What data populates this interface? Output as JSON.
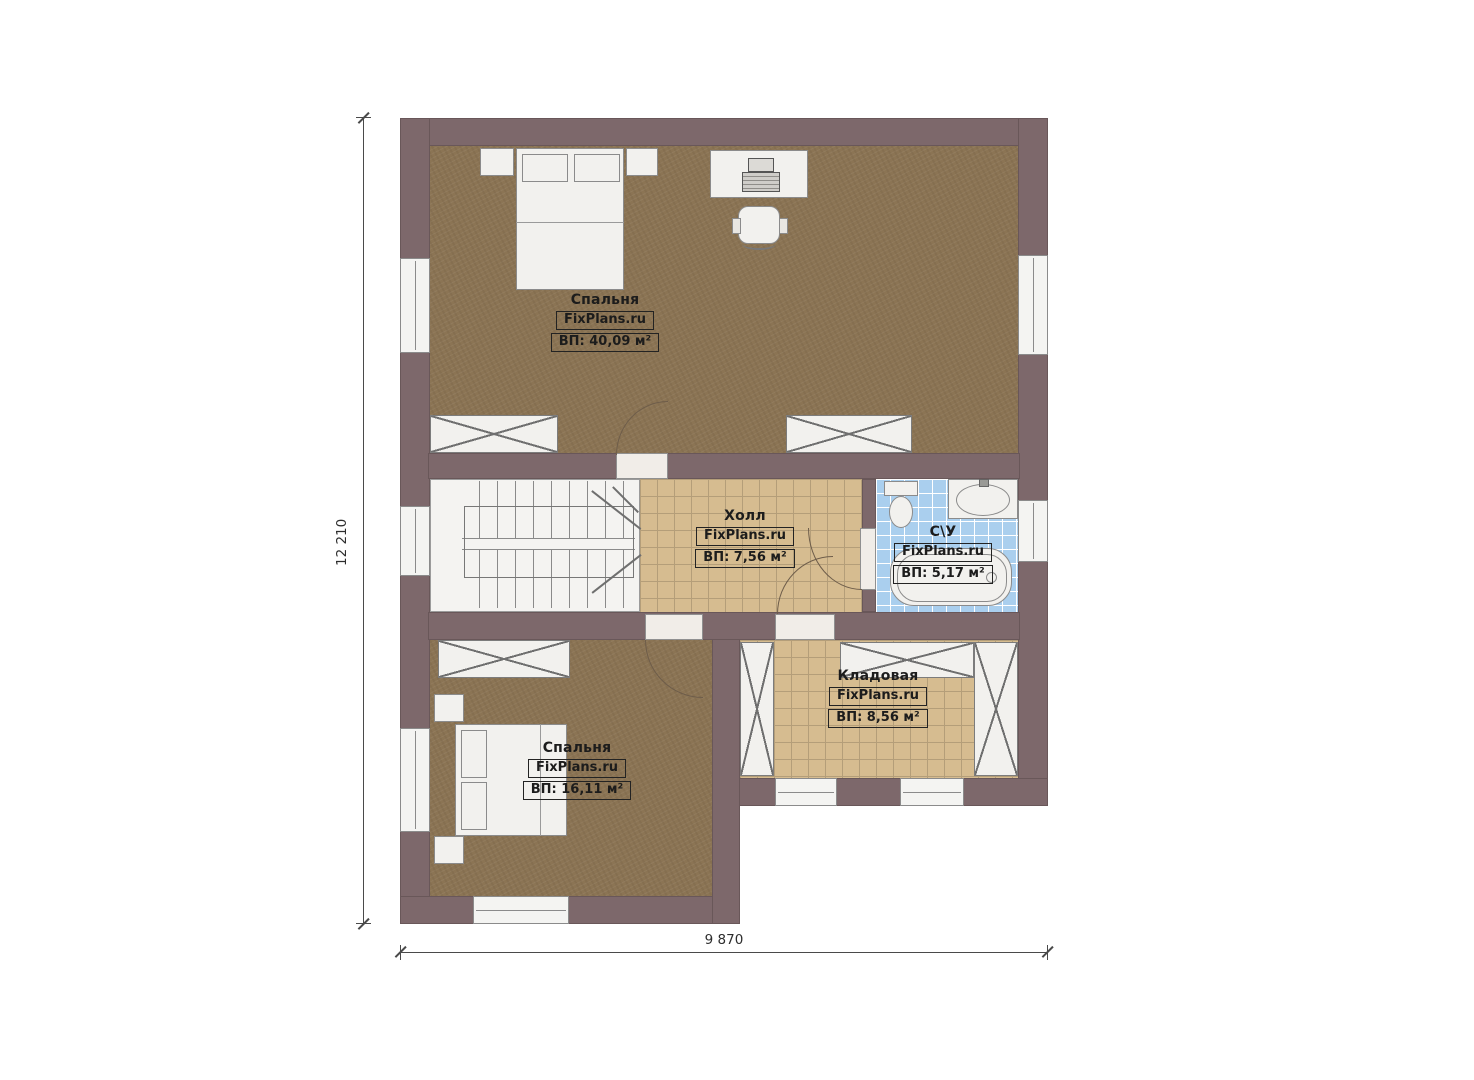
{
  "plan": {
    "type": "floor-plan",
    "brand": "FixPlans.ru",
    "dimensions": {
      "vertical": "12 210",
      "horizontal": "9 870"
    },
    "rooms": [
      {
        "id": "bedroom-top",
        "name": "Спальня",
        "brand": "FixPlans.ru",
        "area": "ВП: 40,09 м²"
      },
      {
        "id": "hall",
        "name": "Холл",
        "brand": "FixPlans.ru",
        "area": "ВП: 7,56 м²"
      },
      {
        "id": "bathroom",
        "name": "С\\У",
        "brand": "FixPlans.ru",
        "area": "ВП: 5,17 м²"
      },
      {
        "id": "storage",
        "name": "Кладовая",
        "brand": "FixPlans.ru",
        "area": "ВП: 8,56 м²"
      },
      {
        "id": "bedroom-bottom",
        "name": "Спальня",
        "brand": "FixPlans.ru",
        "area": "ВП: 16,11 м²"
      }
    ],
    "symbols": [
      "double-bed",
      "nightstand",
      "desk",
      "printer",
      "office-chair",
      "wardrobe",
      "staircase",
      "toilet",
      "sink-counter",
      "bathtub",
      "door",
      "window"
    ],
    "colors": {
      "wall": "#7d686b",
      "wood_floor": "#8b7454",
      "tile_floor": "#d6bc90",
      "tile_grout": "#b49e79",
      "bath_tile": "#aacfee",
      "bath_grout": "#ffffff",
      "fixture_white": "#f2f1ee"
    }
  }
}
